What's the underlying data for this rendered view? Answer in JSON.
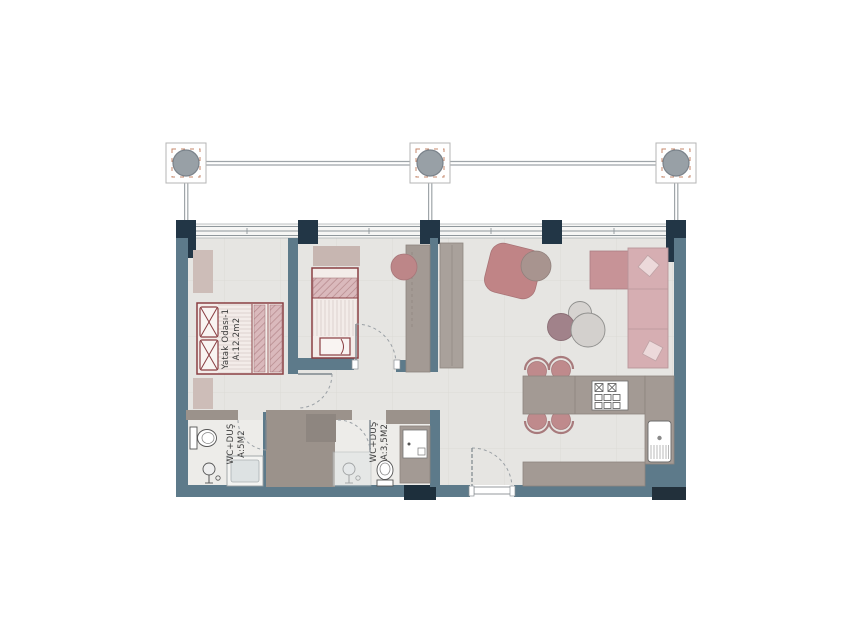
{
  "rooms": {
    "bedroom1": {
      "label": "Yatak Odası-1",
      "area": "A:12.2m2"
    },
    "bathroom1": {
      "label": "WC+DUŞ",
      "area": "A:5M2"
    },
    "bathroom2": {
      "label": "WC+DUŞ",
      "area": "A:3,5M2"
    }
  },
  "colors": {
    "wall_slate": "#5d7a8a",
    "wall_dark": "#223646",
    "wall_taupe": "#9b928b",
    "floor": "#e6e5e2",
    "floor_grid": "#dcdad6",
    "bath_floor": "#edece9",
    "furniture_gray": "#a39a94",
    "bed_frame": "#8a3e42",
    "bed_fill": "#f3ece9",
    "accent_pink": "#c08486",
    "sofa_pink": "#d6aeb2",
    "sofa_dark_pink": "#c79397",
    "table_mauve": "#a1828a",
    "table_light": "#d3d0cd",
    "column_circle": "#98a0a6",
    "line_gray": "#9aa0a5"
  },
  "fixtures": [
    "column-marker",
    "window",
    "double-bed",
    "single-bed",
    "nightstand",
    "dresser",
    "desk",
    "desk-chair",
    "tv-unit",
    "armchair",
    "side-table",
    "coffee-table",
    "sofa",
    "sofa-pillow",
    "dining-table",
    "dining-chair",
    "kitchen-counter",
    "cooktop",
    "kitchen-sink",
    "toilet",
    "shower-head",
    "shower-tray",
    "vanity",
    "entrance-door",
    "interior-door"
  ]
}
